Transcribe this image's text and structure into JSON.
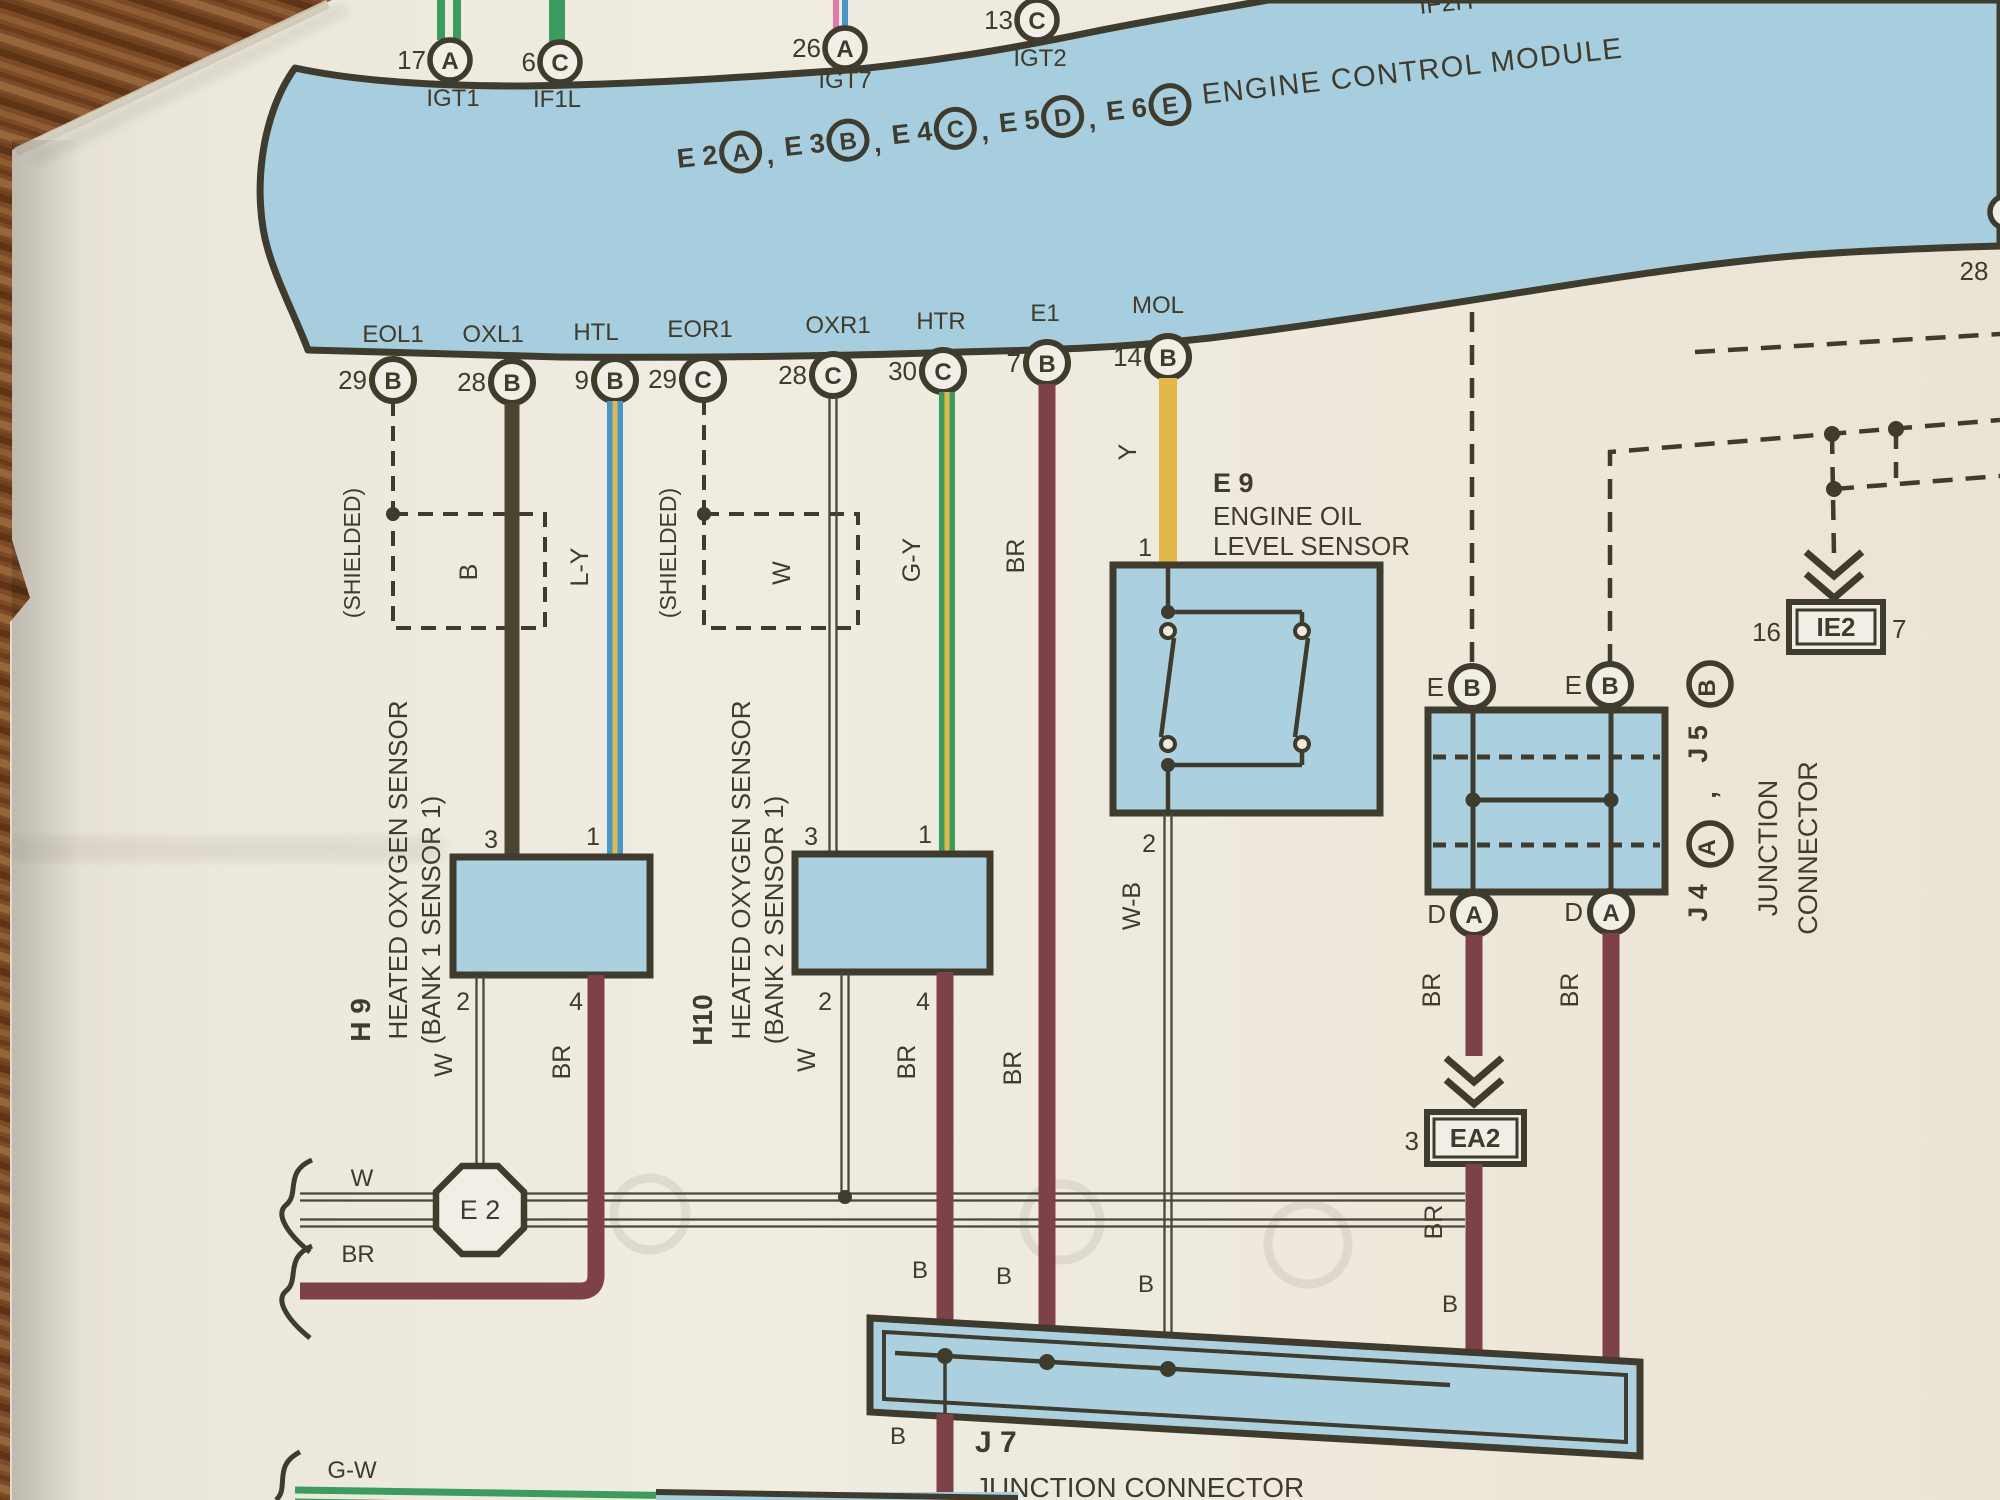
{
  "colors": {
    "paper": "#eeeade",
    "band_blue": "#a6cede",
    "box_blue": "#abd1e0",
    "line_dark": "#3f3b2d",
    "wire_brown": "#7e4049",
    "wire_yellow": "#e3b748",
    "wire_green": "#3a9c5e",
    "wire_blue": "#4497cb",
    "wire_black": "#4a4433",
    "wire_pink": "#e27ba8",
    "wood": "#7c4a26"
  },
  "ecm": {
    "title": "ENGINE CONTROL MODULE",
    "partial_top_label": "IF2H",
    "top_pins": [
      {
        "num": "17",
        "letter": "A",
        "label": "IGT1"
      },
      {
        "num": "6",
        "letter": "C",
        "label": "IF1L"
      },
      {
        "num": "26",
        "letter": "A",
        "label": "IGT7"
      },
      {
        "num": "13",
        "letter": "C",
        "label": "IGT2"
      }
    ],
    "connector_row": [
      {
        "name": "E 2",
        "letter": "A",
        "sep": ","
      },
      {
        "name": "E 3",
        "letter": "B",
        "sep": ","
      },
      {
        "name": "E 4",
        "letter": "C",
        "sep": ","
      },
      {
        "name": "E 5",
        "letter": "D",
        "sep": ","
      },
      {
        "name": "E 6",
        "letter": "E",
        "sep": ""
      }
    ],
    "bottom_pins": [
      {
        "label": "EOL1",
        "num": "29",
        "letter": "B"
      },
      {
        "label": "OXL1",
        "num": "28",
        "letter": "B"
      },
      {
        "label": "HTL",
        "num": "9",
        "letter": "B"
      },
      {
        "label": "EOR1",
        "num": "29",
        "letter": "C"
      },
      {
        "label": "OXR1",
        "num": "28",
        "letter": "C"
      },
      {
        "label": "HTR",
        "num": "30",
        "letter": "C"
      },
      {
        "label": "E1",
        "num": "7",
        "letter": "B"
      },
      {
        "label": "MOL",
        "num": "14",
        "letter": "B"
      }
    ],
    "edge_pin_num": "28"
  },
  "wire_codes": {
    "b": "B",
    "ly": "L-Y",
    "w": "W",
    "gy": "G-Y",
    "br": "BR",
    "y": "Y",
    "wb": "W-B",
    "gw": "G-W"
  },
  "notes": {
    "shielded": "(SHIELDED)"
  },
  "pins": {
    "p1": "1",
    "p2": "2",
    "p3": "3",
    "p4": "4"
  },
  "h9": {
    "id": "H 9",
    "name1": "HEATED OXYGEN SENSOR",
    "name2": "(BANK 1 SENSOR 1)"
  },
  "h10": {
    "id": "H10",
    "name1": "HEATED OXYGEN SENSOR",
    "name2": "(BANK 2 SENSOR 1)"
  },
  "e9": {
    "id": "E 9",
    "name1": "ENGINE OIL",
    "name2": "LEVEL SENSOR",
    "pin_top": "1",
    "pin_bottom": "2"
  },
  "e2": {
    "id": "E 2"
  },
  "j7": {
    "id": "J 7",
    "name": "JUNCTION CONNECTOR"
  },
  "j45": {
    "a_id": "J 4",
    "a_letter": "A",
    "comma": ",",
    "b_id": "J 5",
    "b_letter": "B",
    "name1": "JUNCTION",
    "name2": "CONNECTOR",
    "top_pin": "E",
    "top_letter": "B",
    "bottom_pin": "D",
    "bottom_letter": "A"
  },
  "ie2": {
    "left_num": "16",
    "id": "IE2",
    "right_num": "7"
  },
  "ea2": {
    "num": "3",
    "id": "EA2"
  }
}
